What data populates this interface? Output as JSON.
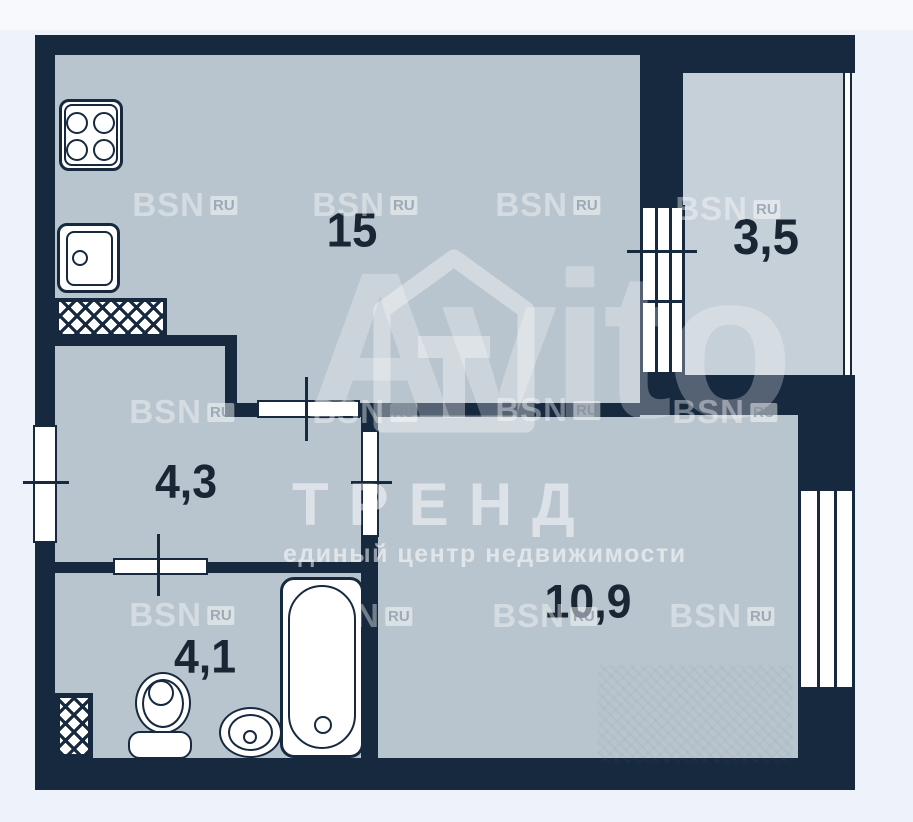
{
  "floorplan": {
    "rooms": [
      {
        "id": "kitchen-living-room",
        "area": "15"
      },
      {
        "id": "balcony",
        "area": "3,5"
      },
      {
        "id": "hallway",
        "area": "4,3"
      },
      {
        "id": "room",
        "area": "10,9"
      },
      {
        "id": "bathroom",
        "area": "4,1"
      }
    ]
  },
  "watermarks": {
    "bsn": "BSN",
    "bsn_badge": "RU",
    "portal": "Avito",
    "agency": "ТРЕНД",
    "tagline": "единый центр недвижимости"
  },
  "colors": {
    "wall": "#16293f",
    "room_fill": "#b9c5ce",
    "balcony_fill": "#c6d0d8",
    "background": "#eef2fb",
    "fixture_fill": "#ffffff",
    "label_text": "#1a2634"
  }
}
